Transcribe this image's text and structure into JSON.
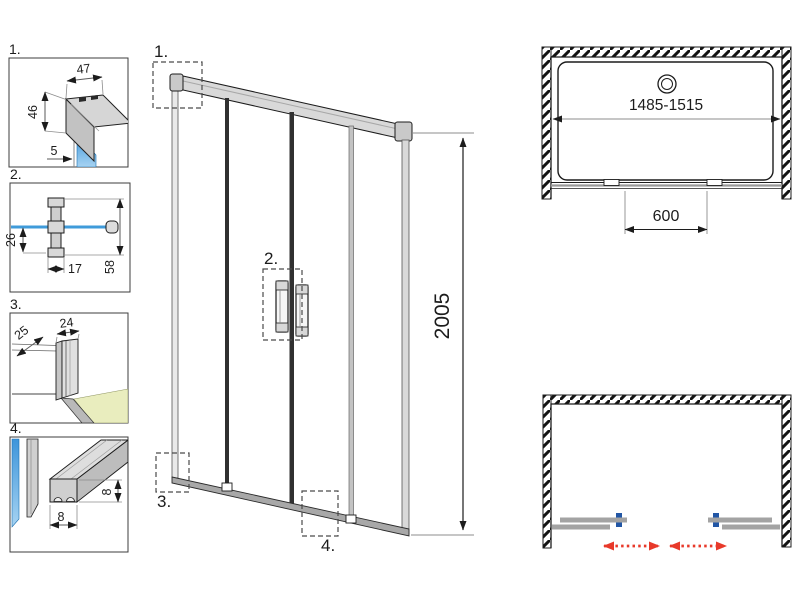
{
  "drawing_type": "shower-sliding-door-technical-drawing",
  "colors": {
    "glass_blue": "#4a9fe3",
    "glass_blue_light": "#a6d3f2",
    "floor_green": "#e9edbe",
    "profile_gray": "#cfcfcf",
    "panel_gray": "#a3a3a3",
    "dimension_gray": "#8c8c8c",
    "line_black": "#1c1c1c",
    "arrow_red": "#e8392a",
    "handle_blue": "#2256a5"
  },
  "details": [
    {
      "label": "1.",
      "dim_width": "47",
      "dim_height": "46",
      "dim_glass": "5"
    },
    {
      "label": "2.",
      "dim_offset": "26",
      "dim_depth": "17",
      "dim_height": "58"
    },
    {
      "label": "3.",
      "dim_depth": "25",
      "dim_width": "24"
    },
    {
      "label": "4.",
      "dim_width": "8",
      "dim_height": "8"
    }
  ],
  "front_view": {
    "callout_top": "1.",
    "callout_handles": "2.",
    "callout_bottom_left": "3.",
    "callout_bottom_center": "4.",
    "dim_height": "2005"
  },
  "plan_view": {
    "dim_width_range": "1485-1515",
    "dim_opening": "600"
  }
}
